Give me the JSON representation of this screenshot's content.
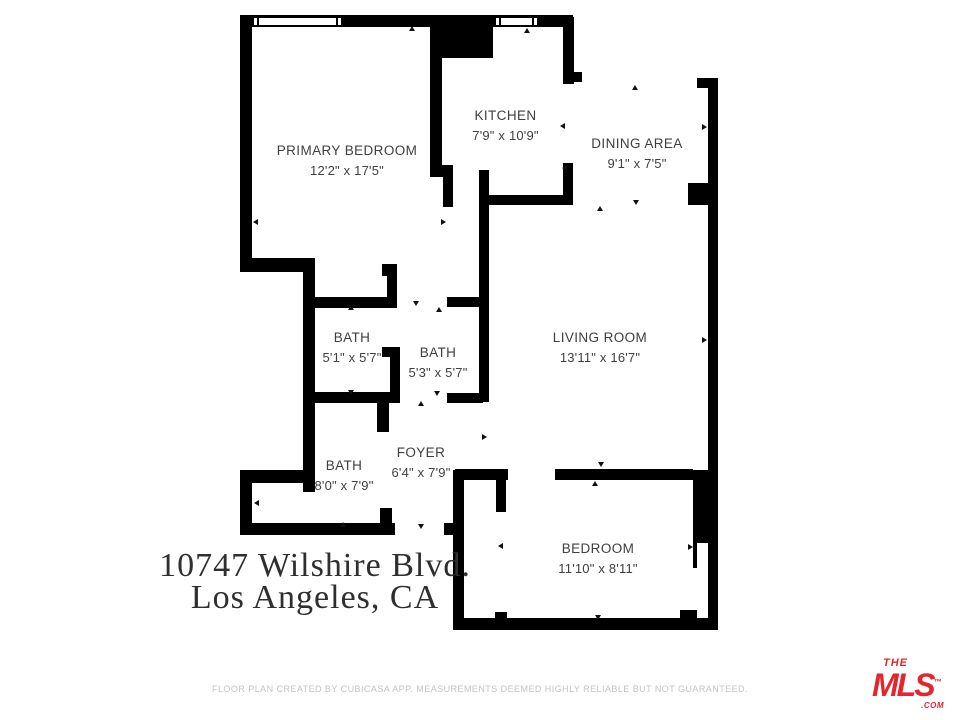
{
  "rooms": [
    {
      "id": "primary-bedroom",
      "name": "PRIMARY BEDROOM",
      "dims": "12'2\" x 17'5\""
    },
    {
      "id": "kitchen",
      "name": "KITCHEN",
      "dims": "7'9\" x 10'9\""
    },
    {
      "id": "dining-area",
      "name": "DINING AREA",
      "dims": "9'1\" x 7'5\""
    },
    {
      "id": "living-room",
      "name": "LIVING ROOM",
      "dims": "13'11\" x 16'7\""
    },
    {
      "id": "bath-upper",
      "name": "BATH",
      "dims": "5'1\" x 5'7\""
    },
    {
      "id": "bath-middle",
      "name": "BATH",
      "dims": "5'3\" x 5'7\""
    },
    {
      "id": "bath-lower",
      "name": "BATH",
      "dims": "8'0\" x 7'9\""
    },
    {
      "id": "foyer",
      "name": "FOYER",
      "dims": "6'4\" x 7'9\""
    },
    {
      "id": "bedroom",
      "name": "BEDROOM",
      "dims": "11'10\" x 8'11\""
    }
  ],
  "address": {
    "line1": "10747 Wilshire Blvd.",
    "line2": "Los Angeles, CA"
  },
  "footer": {
    "disclaimer": "FLOOR PLAN CREATED BY CUBICASA APP. MEASUREMENTS DEEMED HIGHLY RELIABLE BUT NOT GUARANTEED."
  },
  "logo": {
    "the": "THE",
    "mls": "MLS",
    "tm": "™",
    "com": ".COM"
  },
  "colors": {
    "background": "#ffffff",
    "wall": "#000000",
    "room_label": "#3f3f3f",
    "address_text": "#2f2f2f",
    "disclaimer_text": "#c3c3c3",
    "logo_red": "#e4262c"
  }
}
